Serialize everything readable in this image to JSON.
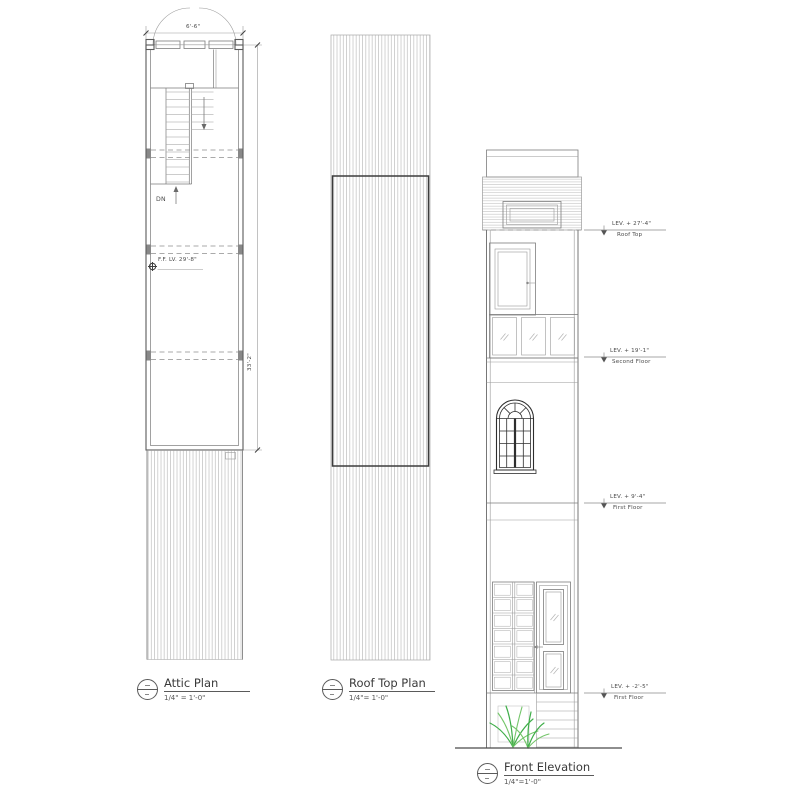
{
  "drawing": {
    "background": "#ffffff",
    "ink_color": "#4a4a4a",
    "hatch_color": "#b5b5b5",
    "plant_color": "#3fae49"
  },
  "attic_plan": {
    "title": "Attic Plan",
    "scale": "1/4\" = 1'-0\"",
    "top_dimension": "6'-6\"",
    "right_dimension": "33'-2\"",
    "ff_level_note": "F.F. LV. 29'-8\"",
    "stair_label": "DN"
  },
  "roof_top_plan": {
    "title": "Roof Top Plan",
    "scale": "1/4\"= 1'-0\""
  },
  "front_elevation": {
    "title": "Front Elevation",
    "scale": "1/4\"=1'-0\"",
    "levels": [
      {
        "elevation": "LEV. + 27'-4\"",
        "floor": "Roof Top"
      },
      {
        "elevation": "LEV. + 19'-1\"",
        "floor": "Second Floor"
      },
      {
        "elevation": "LEV. + 9'-4\"",
        "floor": "First Floor"
      },
      {
        "elevation": "LEV. + -2'-5\"",
        "floor": "First Floor"
      }
    ]
  }
}
